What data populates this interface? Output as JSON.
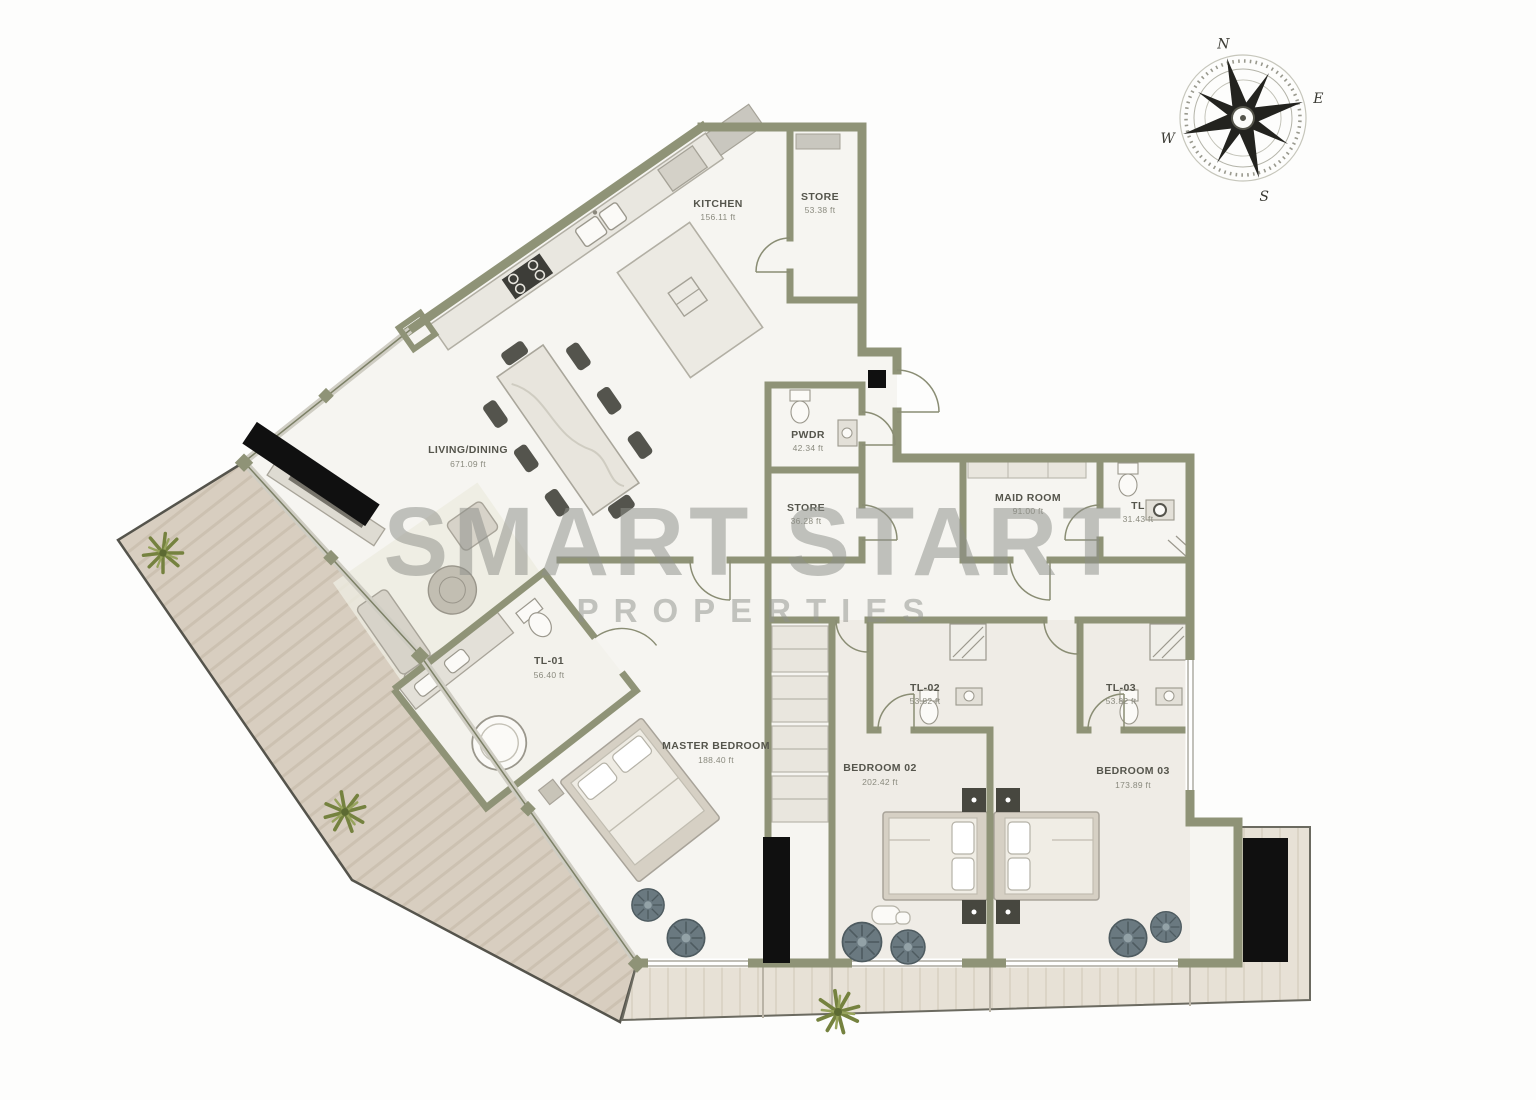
{
  "watermark": {
    "line1": "SMART START",
    "line2": "PROPERTIES"
  },
  "compass": {
    "north": "N",
    "east": "E",
    "south": "S",
    "west": "W"
  },
  "colors": {
    "wall": "#8f9377",
    "wall_dark": "#6f735a",
    "black_wall": "#101010",
    "floor": "#f6f5f1",
    "terrace": "#d8cec0",
    "balcony": "#e7e1d6",
    "furniture": "#dbd8d0",
    "plant_green": "#75823f",
    "pot_plant": "#6a7980",
    "watermark": "#8e908a"
  },
  "rooms": [
    {
      "id": "kitchen",
      "label": "KITCHEN",
      "area": "156.11 ft"
    },
    {
      "id": "store-top",
      "label": "STORE",
      "area": "53.38 ft"
    },
    {
      "id": "living-dining",
      "label": "LIVING/DINING",
      "area": "671.09 ft"
    },
    {
      "id": "powder-room",
      "label": "PWDR",
      "area": "42.34 ft"
    },
    {
      "id": "store-small",
      "label": "STORE",
      "area": "36.28 ft"
    },
    {
      "id": "maid-room",
      "label": "MAID ROOM",
      "area": "91.00 ft"
    },
    {
      "id": "maid-toilet",
      "label": "TL",
      "area": "31.43 ft"
    },
    {
      "id": "toilet-01",
      "label": "TL-01",
      "area": "56.40 ft"
    },
    {
      "id": "master-bedroom",
      "label": "MASTER BEDROOM",
      "area": "188.40 ft"
    },
    {
      "id": "bedroom-02",
      "label": "BEDROOM 02",
      "area": "202.42 ft"
    },
    {
      "id": "toilet-02",
      "label": "TL-02",
      "area": "53.82 ft"
    },
    {
      "id": "bedroom-03",
      "label": "BEDROOM 03",
      "area": "173.89 ft"
    },
    {
      "id": "toilet-03",
      "label": "TL-03",
      "area": "53.82 ft"
    }
  ]
}
